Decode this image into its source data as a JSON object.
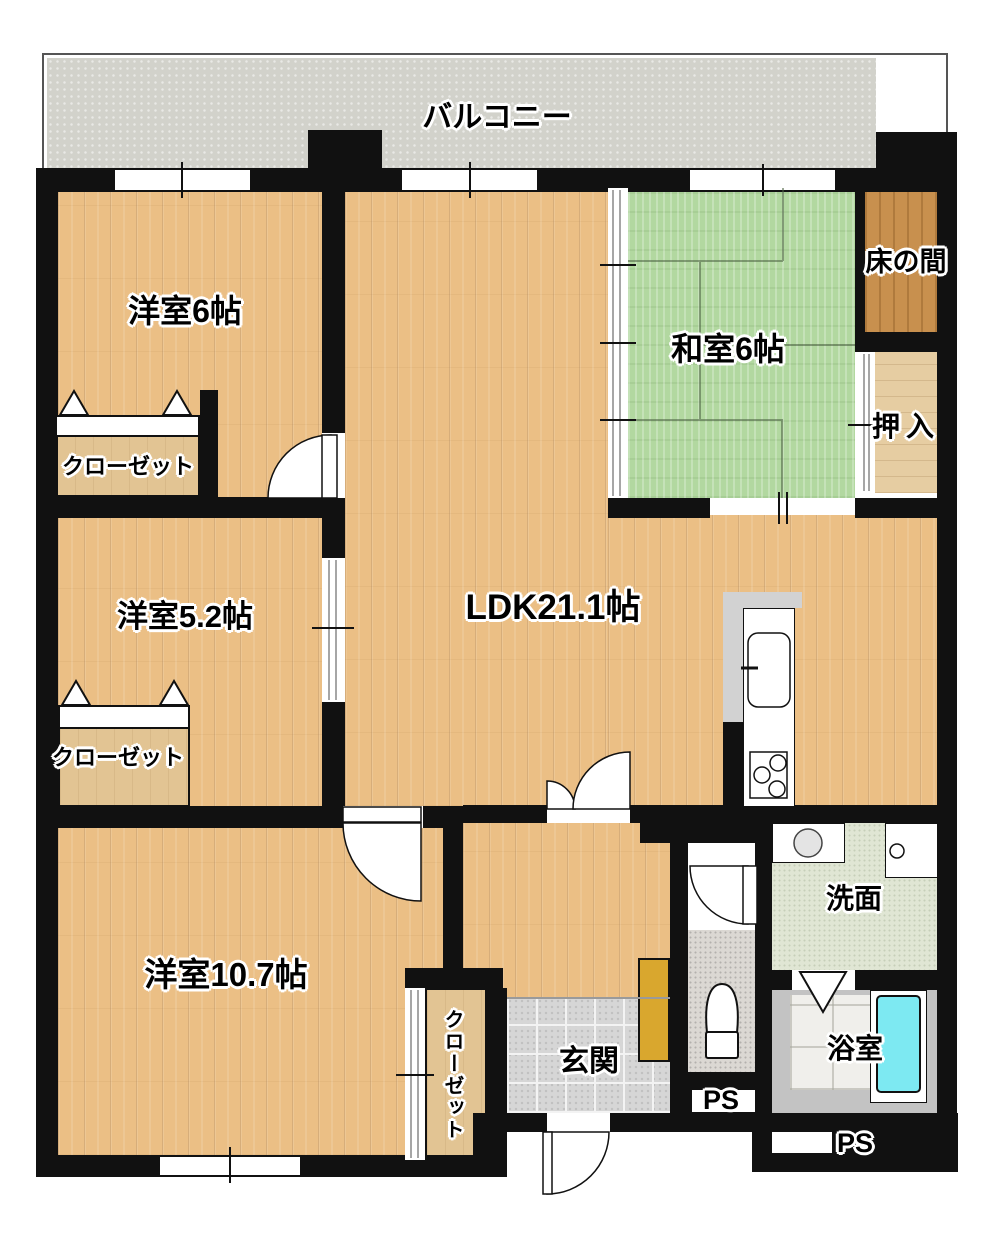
{
  "labels": {
    "balcony": "バルコニー",
    "western_6": "洋室6帖",
    "japanese_6": "和室6帖",
    "tokonoma": "床の間",
    "oshiire": "押入",
    "closet_a": "クローゼット",
    "closet_b": "クローゼット",
    "closet_c": "クローゼット",
    "western_52": "洋室5.2帖",
    "ldk": "LDK21.1帖",
    "western_107": "洋室10.7帖",
    "genkan": "玄関",
    "washroom": "洗面",
    "bathroom": "浴室",
    "ps_1": "PS",
    "ps_2": "PS"
  },
  "colors": {
    "wall": "#111111",
    "wood_floor": "#ebbf85",
    "tatami": "#b2d8a0",
    "balcony": "#d2d2cb",
    "tokonoma_wood": "#c8904e",
    "bathtub": "#7de9f2",
    "shoe_cabinet": "#d9a72e"
  }
}
